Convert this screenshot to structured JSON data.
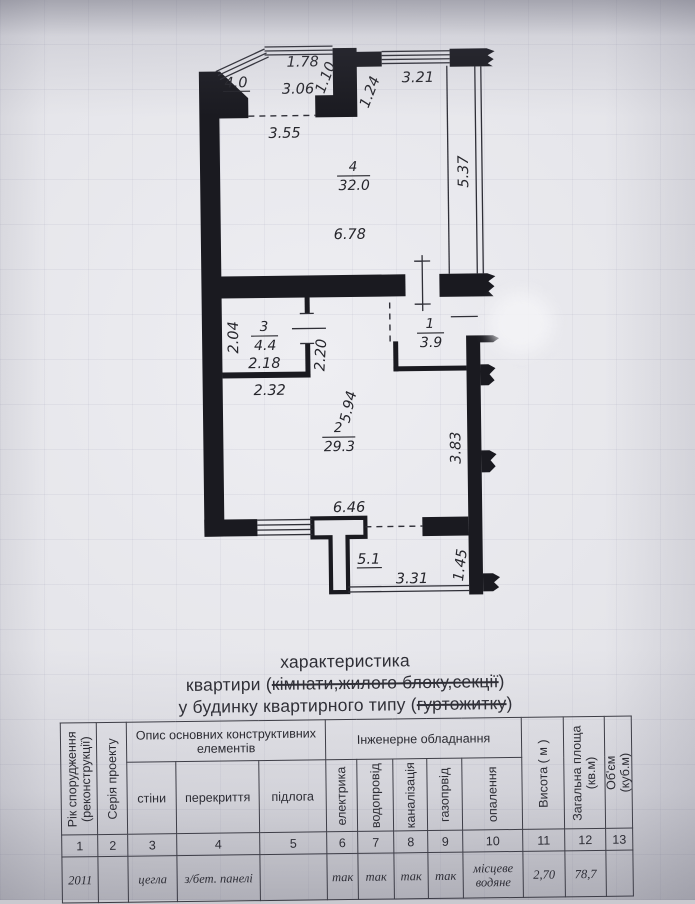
{
  "colors": {
    "paper": "#e7e7ec",
    "ink": "#1a1a20",
    "thin_line": "#2f2f37",
    "table_line": "#3b3b43"
  },
  "plan": {
    "dims": [
      {
        "text": "4.0"
      },
      {
        "text": "1.78"
      },
      {
        "text": "1.10"
      },
      {
        "text": "3.06"
      },
      {
        "text": "1.24"
      },
      {
        "text": "3.21"
      },
      {
        "text": "3.55"
      },
      {
        "text": "5.37"
      },
      {
        "text": "6.78"
      },
      {
        "text": "2.04"
      },
      {
        "text": "2.18"
      },
      {
        "text": "2.20"
      },
      {
        "text": "2.32"
      },
      {
        "text": "5.94"
      },
      {
        "text": "3.83"
      },
      {
        "text": "6.46"
      },
      {
        "text": "5.1"
      },
      {
        "text": "3.31"
      },
      {
        "text": "1.45"
      }
    ],
    "rooms": [
      {
        "number": "4",
        "area": "32.0"
      },
      {
        "number": "3",
        "area": "4.4"
      },
      {
        "number": "1",
        "area": "3.9"
      },
      {
        "number": "2",
        "area": "29.3"
      }
    ]
  },
  "heading": {
    "line1": "характеристика",
    "line2_pre": "квартири (",
    "line2_struck": "кімнати,жилого блоку,секції",
    "line2_post": ")",
    "line3_pre": "у будинку квартирного типу (",
    "line3_struck": "гуртожитку",
    "line3_post": ")"
  },
  "table": {
    "group_construct": "Опис основних конструктивних елементів",
    "group_engineering": "Інженерне обладнання",
    "columns": [
      {
        "num": "1",
        "header": "Рік спорудження",
        "header2": "(реконструкції)",
        "value": "2011"
      },
      {
        "num": "2",
        "header": "Серія проекту",
        "value": ""
      },
      {
        "num": "3",
        "header": "стіни",
        "value": "цегла"
      },
      {
        "num": "4",
        "header": "перекриття",
        "value": "з/бет. панелі"
      },
      {
        "num": "5",
        "header": "підлога",
        "value": ""
      },
      {
        "num": "6",
        "header": "електрика",
        "value": "так"
      },
      {
        "num": "7",
        "header": "водопровід",
        "value": "так"
      },
      {
        "num": "8",
        "header": "каналізація",
        "value": "так"
      },
      {
        "num": "9",
        "header": "газопрвід",
        "value": "так"
      },
      {
        "num": "10",
        "header": "опалення",
        "value": "місцеве водяне"
      },
      {
        "num": "11",
        "header": "Висота ( м )",
        "value": "2,70"
      },
      {
        "num": "12",
        "header": "Загальна площа",
        "header2": "(кв.м)",
        "value": "78,7"
      },
      {
        "num": "13",
        "header": "Об'єм",
        "header2": "(куб.м)",
        "value": ""
      }
    ]
  }
}
